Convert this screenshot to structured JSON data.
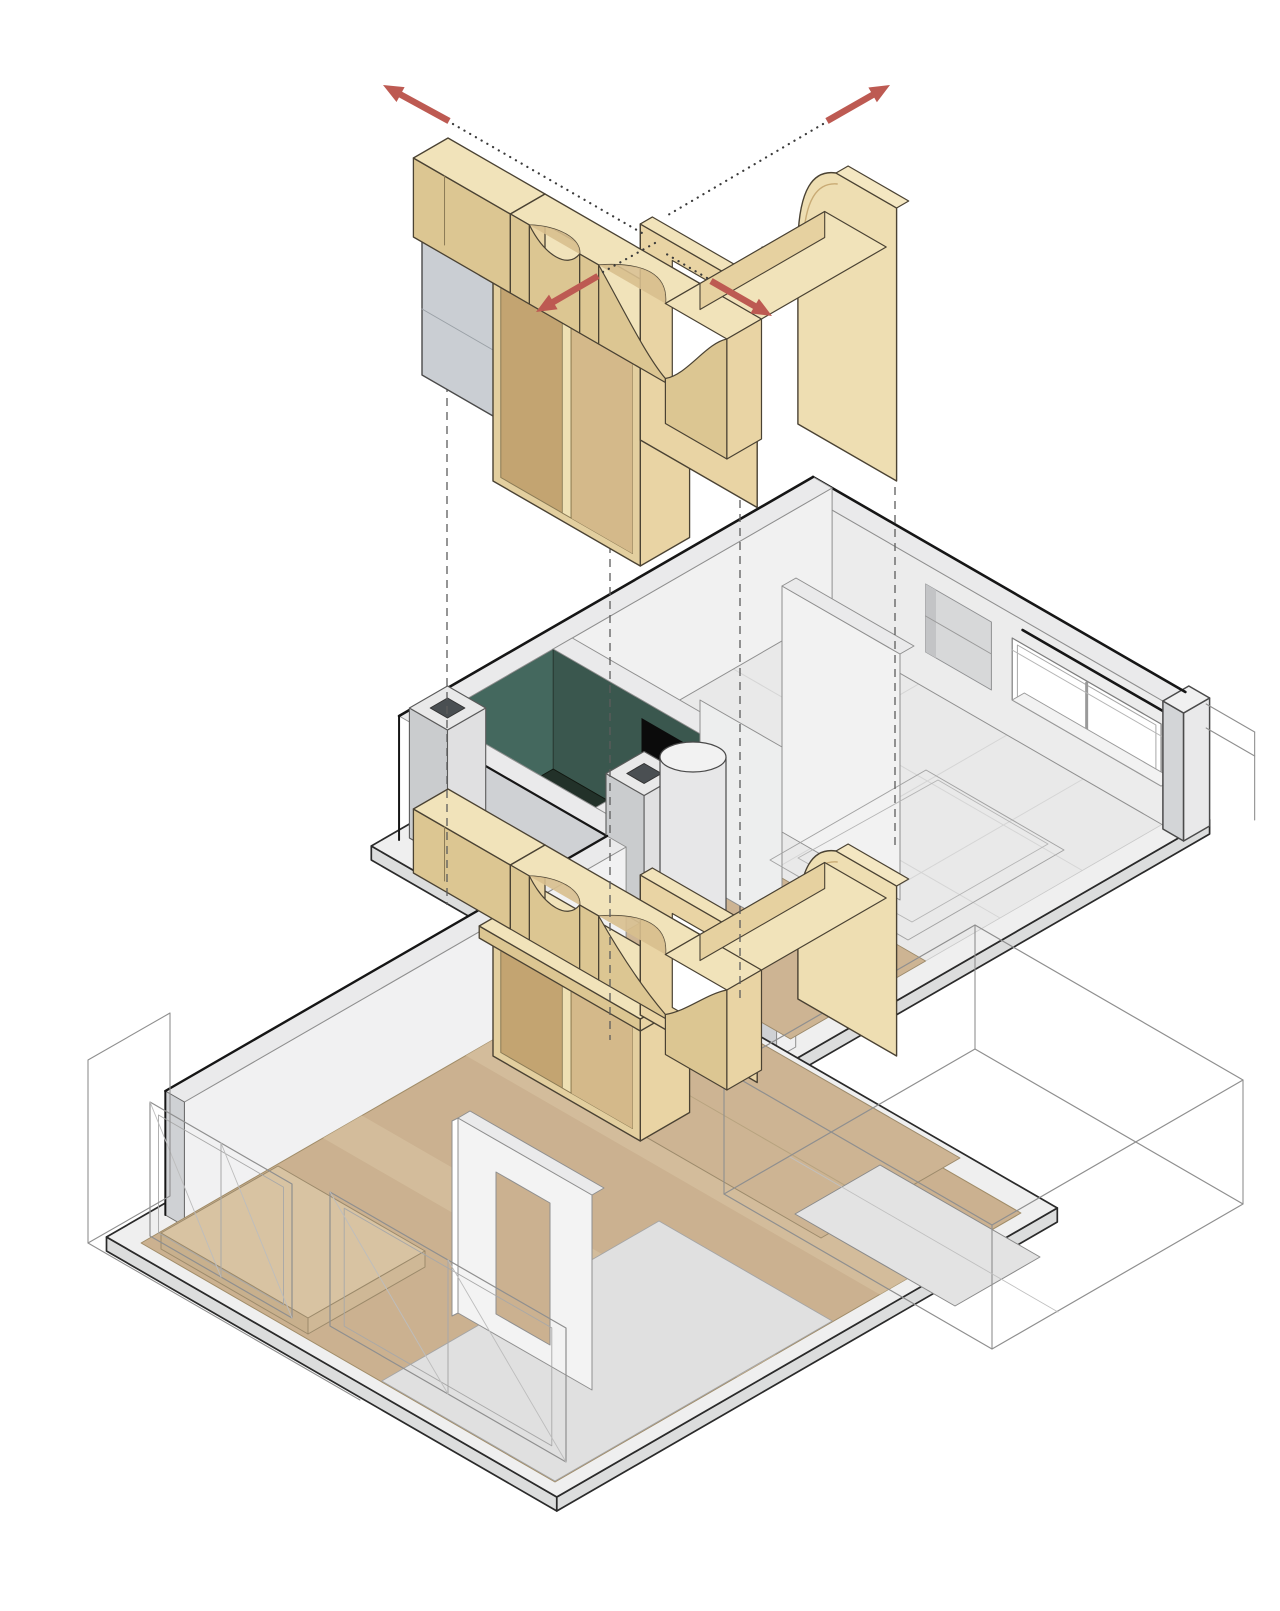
{
  "figure": {
    "type": "axonometric-exploded-diagram",
    "subject": "apartment-plan-with-timber-joinery-unit-exploded-above",
    "background": "#ffffff"
  },
  "palette": {
    "wood_top": "#f1e3ba",
    "wood_side_se": "#e9d4a4",
    "wood_side_sw": "#dcc692",
    "wood_soffit": "#d8bf8e",
    "wood_frame": "#e3cf9f",
    "wood_interior_dark": "#c3a471",
    "wood_divider": "#eee0b3",
    "wood_edge": "#38322454",
    "wood_outline": "#352e21",
    "wall_top": "#eaeaeb",
    "wall_face_se": "#f1f1f2",
    "wall_face_sw": "#cfd1d4",
    "wall_interior": "#ececec",
    "wall_outline": "#5a5a5a",
    "slab_top": "#efefef",
    "slab_side": "#dcdddd",
    "cabinet_face_se": "#e3e5e7",
    "cabinet_face_sw": "#caced3",
    "teal_wall_se": "#44685e",
    "teal_wall_sw": "#3a574e",
    "bathroom_floor": "#223129",
    "bathroom_floor_dark": "#141d19",
    "doorway_black": "#0b0b0b",
    "floor_wood": "#cbb190",
    "floor_plank": "#d4bf9e",
    "floor_deck": "#cdb493",
    "floor_gray": "#e9e9e9",
    "kitchen_gray": "#e0e0e0",
    "platform_wood": "#d8c3a2",
    "glass_white": "#ffffff",
    "wireframe_line": "#8f8f8f",
    "tile_line": "#d5d5d5",
    "dashed_line": "#5c5c5c",
    "dotted_line": "#3b3b3b",
    "arrow_red": "#bd5a52",
    "outline_dark": "#161616"
  },
  "annotations": {
    "arrows": [
      {
        "id": "arrow-up-left",
        "direction": "up-left"
      },
      {
        "id": "arrow-up-right",
        "direction": "up-right"
      },
      {
        "id": "arrow-down-left",
        "direction": "down-left"
      },
      {
        "id": "arrow-down-right",
        "direction": "down-right"
      }
    ],
    "projection": {
      "dashed_drop_lines": 4,
      "dotted_leader_lines": 4
    }
  },
  "components": {
    "exploded_unit": [
      "storage-cabinet",
      "arched-lintel-beam",
      "corner-arch-beam",
      "wardrobe-box",
      "door-frame-panel",
      "curved-corner-panel"
    ],
    "plan": [
      "bedroom",
      "bathroom",
      "hall-joinery",
      "living-room",
      "balcony",
      "window-wall",
      "niche",
      "round-column"
    ]
  }
}
